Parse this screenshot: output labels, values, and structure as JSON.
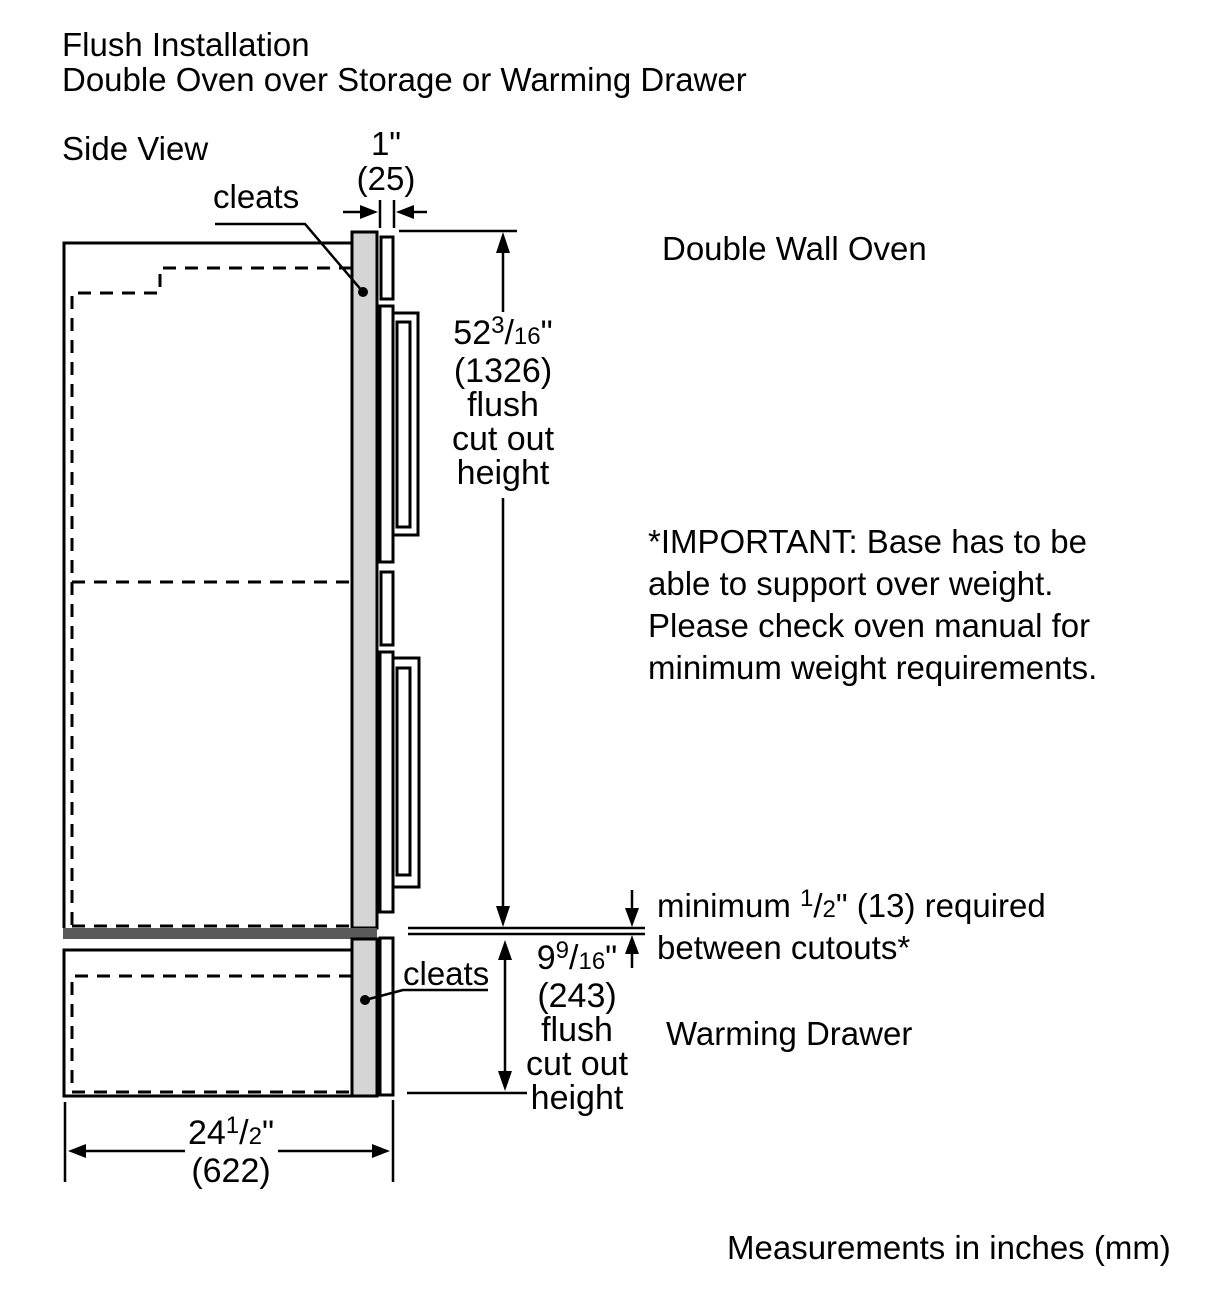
{
  "header": {
    "title_line1": "Flush Installation",
    "title_line2": "Double Oven over Storage or Warming Drawer",
    "view_label": "Side View"
  },
  "labels": {
    "cleats_top": "cleats",
    "cleats_bottom": "cleats",
    "double_wall_oven": "Double Wall Oven",
    "warming_drawer": "Warming Drawer"
  },
  "dimensions": {
    "top_gap": {
      "inches": "1\"",
      "mm": "(25)"
    },
    "oven_cutout": {
      "whole": "52",
      "numerator": "3",
      "slash": "/",
      "denominator": "16",
      "unit": "\"",
      "mm": "(1326)",
      "line1": "flush",
      "line2": "cut out",
      "line3": "height"
    },
    "drawer_cutout": {
      "whole": "9",
      "numerator": "9",
      "slash": "/",
      "denominator": "16",
      "unit": "\"",
      "mm": "(243)",
      "line1": "flush",
      "line2": "cut out",
      "line3": "height"
    },
    "depth": {
      "whole": "24",
      "numerator": "1",
      "slash": "/",
      "denominator": "2",
      "unit": "\"",
      "mm": "(622)"
    }
  },
  "notes": {
    "min_gap": {
      "prefix": "minimum ",
      "numerator": "1",
      "slash": "/",
      "denominator": "2",
      "suffix": "\" (13) required",
      "line2": "between cutouts*"
    },
    "important": {
      "line1": "*IMPORTANT: Base has to be",
      "line2": "able to support over weight.",
      "line3": "Please check oven manual for",
      "line4": "minimum weight requirements."
    },
    "footer": "Measurements in inches (mm)"
  },
  "colors": {
    "cleat_fill": "#d5d5d5",
    "base_bar_fill": "#595959",
    "line_color": "#000000",
    "background": "#ffffff"
  }
}
